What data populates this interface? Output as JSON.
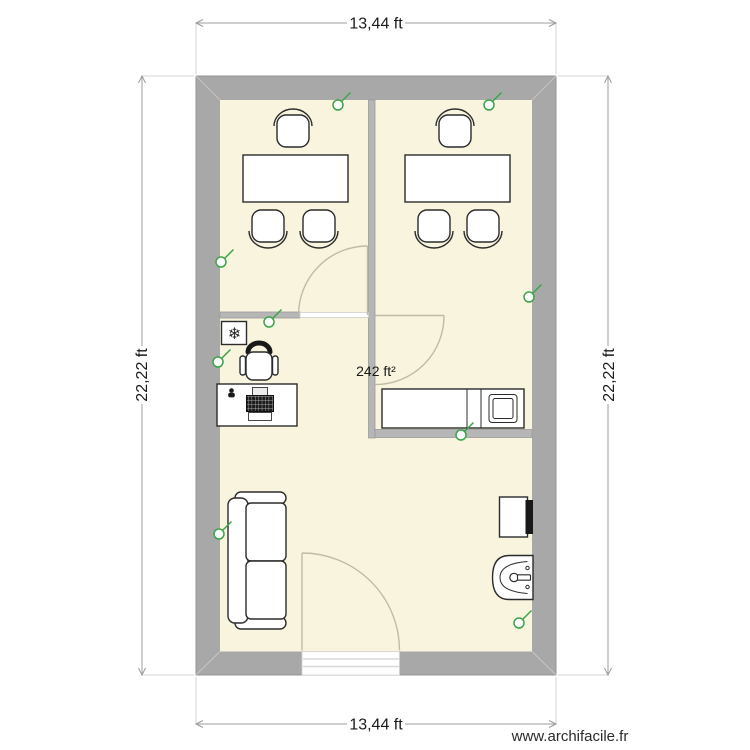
{
  "plan": {
    "dimension_top": "13,44 ft",
    "dimension_bottom": "13,44 ft",
    "dimension_left": "22,22 ft",
    "dimension_right": "22,22 ft",
    "area_label": "242 ft²",
    "watermark": "www.archifacile.fr"
  },
  "icons": {
    "snowflake": "❄",
    "power_outlet": "circle-with-tick"
  },
  "colors": {
    "floor": "#f8f4dd",
    "exterior_wall": "#a8a8a8",
    "interior_wall": "#b6b6b6",
    "outlet_green": "#3aa54a",
    "door_arc": "#c2baa9",
    "dimension_line": "#9c9c9c",
    "text": "#1a1a1a",
    "background": "#ffffff"
  }
}
